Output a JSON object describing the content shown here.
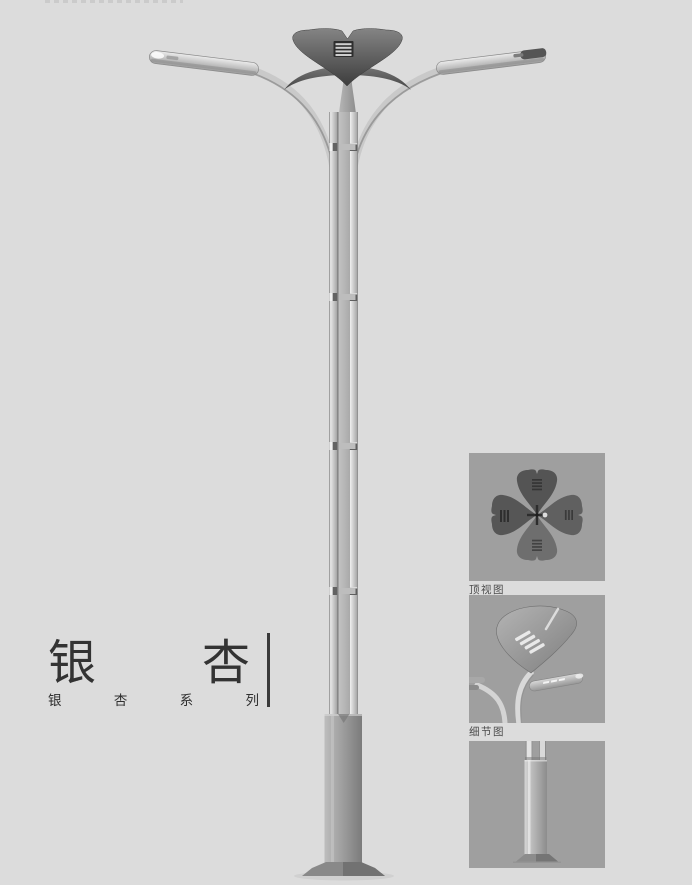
{
  "product": {
    "name": "银杏",
    "title_chars": [
      "银",
      "杏"
    ],
    "series_text": "银杏系列",
    "series_chars": [
      "银",
      "杏",
      "系",
      "列"
    ]
  },
  "panels": {
    "items": [
      {
        "label": "顶视图",
        "image": "lamp-top-view"
      },
      {
        "label": "细节图",
        "image": "lamp-head-detail"
      },
      {
        "label": "",
        "image": "pole-base-view"
      }
    ]
  },
  "colors": {
    "page_bg": "#dcdcdc",
    "panel_bg": "#9f9f9f",
    "metal_light": "#e8e8e8",
    "metal_mid": "#b4b4b4",
    "metal_dark": "#4e4e4e",
    "text": "#333333"
  }
}
